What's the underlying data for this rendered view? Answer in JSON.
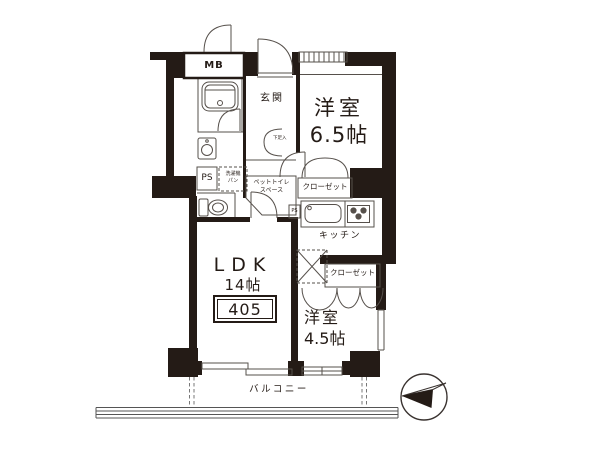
{
  "floor_plan": {
    "unit_number": "405",
    "rooms": {
      "western1": {
        "name": "洋室",
        "size": "6.5帖"
      },
      "western2": {
        "name": "洋室",
        "size": "4.5帖"
      },
      "ldk": {
        "name": "LDK",
        "size": "14帖"
      },
      "kitchen": {
        "label": "キッチン"
      },
      "entrance": {
        "label": "玄関"
      },
      "balcony": {
        "label": "バルコニー"
      }
    },
    "features": {
      "meter_box": "MB",
      "pipe_space": "PS",
      "pipe_space_small": "PS",
      "washing_machine_pan": [
        "洗濯機",
        "パン"
      ],
      "pet_toilet_space": [
        "ペットトイレ",
        "スペース"
      ],
      "closet_upper": "クローゼット",
      "closet_lower": "クローゼット",
      "shoe_cabinet": "下足入"
    },
    "colors": {
      "wall": "#241b16",
      "thin_line": "#56504b",
      "background": "#ffffff"
    }
  }
}
